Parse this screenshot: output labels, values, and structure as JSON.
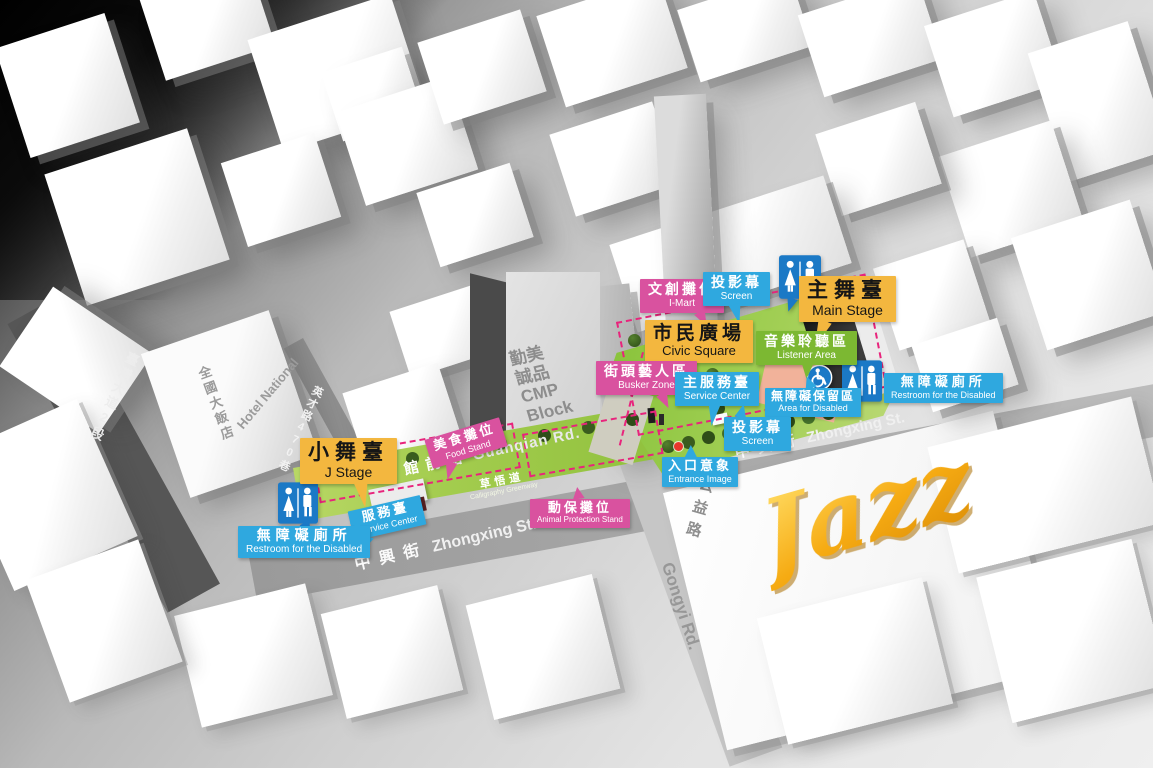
{
  "colors": {
    "yellow": "#F3B73F",
    "pink": "#D9529F",
    "blue": "#2FA8DF",
    "green": "#7CB832",
    "iconblue": "#1B79C6",
    "dash": "#E8247C",
    "gold": "#F2A71B"
  },
  "roads": {
    "taiwan_blvd": "臺灣大道2段",
    "yingcai_lane": "英才路470巷",
    "guanqian": {
      "zh": "館前路",
      "en": "Guanqian Rd."
    },
    "zhongxing_left": {
      "zh": "中興街",
      "en": "Zhongxing St."
    },
    "zhongxing_right": {
      "zh": "中興街",
      "en": "Zhongxing St."
    },
    "gongyi": {
      "zh": "公益路",
      "en": "Gongyi Rd."
    }
  },
  "buildings": {
    "hotel": {
      "en": "Hotel National",
      "zh": "全國大飯店"
    },
    "cmp": {
      "zh1": "勤美",
      "zh2": "誠品",
      "en1": "CMP",
      "en2": "Block"
    }
  },
  "areas": {
    "greenway": {
      "zh": "草悟道",
      "en": "Calligraphy Greenway"
    }
  },
  "labels": {
    "i_mart": {
      "zh": "文創攤位",
      "en": "I-Mart"
    },
    "screen_top": {
      "zh": "投影幕",
      "en": "Screen"
    },
    "main_stage": {
      "zh": "主舞臺",
      "en": "Main Stage"
    },
    "civic_square": {
      "zh": "市民廣場",
      "en": "Civic Square"
    },
    "listener_area": {
      "zh": "音樂聆聽區",
      "en": "Listener Area"
    },
    "busker_zone": {
      "zh": "街頭藝人區",
      "en": "Busker Zone"
    },
    "main_service": {
      "zh": "主服務臺",
      "en": "Service Center"
    },
    "area_disabled": {
      "zh": "無障礙保留區",
      "en": "Area for Disabled"
    },
    "restroom_right": {
      "zh": "無障礙廁所",
      "en": "Restroom for the Disabled"
    },
    "screen_bottom": {
      "zh": "投影幕",
      "en": "Screen"
    },
    "entrance": {
      "zh": "入口意象",
      "en": "Entrance Image"
    },
    "j_stage": {
      "zh": "小舞臺",
      "en": "J Stage"
    },
    "food_stand": {
      "zh": "美食攤位",
      "en": "Food Stand"
    },
    "service_left": {
      "zh": "服務臺",
      "en": "Service Center"
    },
    "restroom_left": {
      "zh": "無障礙廁所",
      "en": "Restroom for the Disabled"
    },
    "animal_stand": {
      "zh": "動保攤位",
      "en": "Animal Protection Stand"
    }
  },
  "logo": {
    "text": "Jazz"
  }
}
